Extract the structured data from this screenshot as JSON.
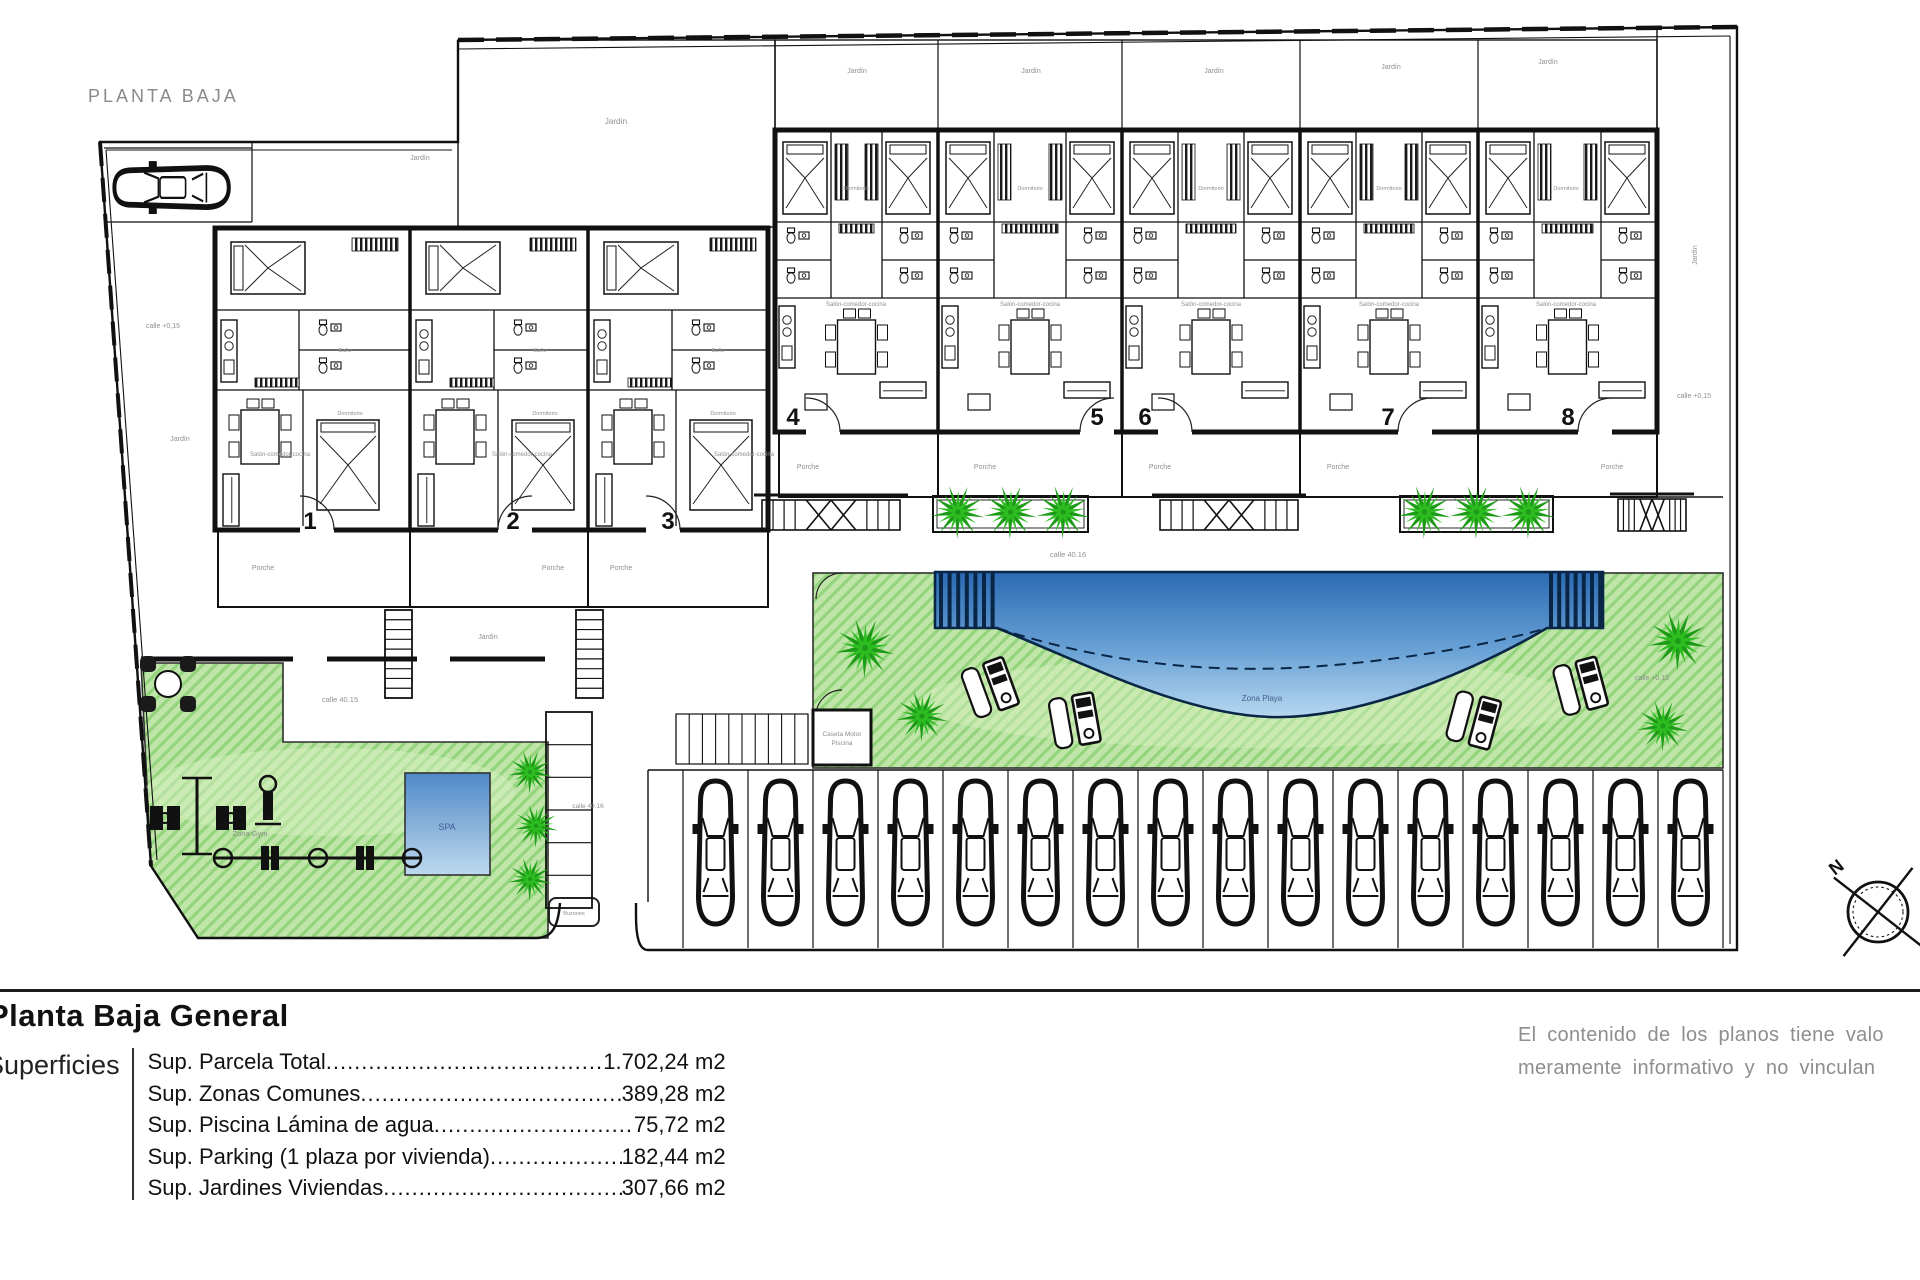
{
  "header": {
    "plan_label": "PLANTA BAJA"
  },
  "plan": {
    "units": [
      {
        "number": "1"
      },
      {
        "number": "2"
      },
      {
        "number": "3"
      },
      {
        "number": "4"
      },
      {
        "number": "5"
      },
      {
        "number": "6"
      },
      {
        "number": "7"
      },
      {
        "number": "8"
      }
    ],
    "parking": {
      "spaces": 16
    },
    "labels": {
      "porche": "Porche",
      "jardin": "Jardín",
      "salon": "Salón-comedor-cocina",
      "dormitorio": "Dormitorio",
      "bano": "Baño",
      "zona_gym": "Zona Gym",
      "spa": "SPA",
      "zona_playa": "Zona Playa",
      "caseta_1": "Caseta Motor",
      "caseta_2": "Piscina",
      "buzones": "Buzones",
      "calle_4015": "calle 40.15",
      "calle_4016": "calle 40.16",
      "cota": "calle +0,15",
      "north": "N"
    },
    "colors": {
      "lawn": "#bfe6a8",
      "lawn_stripe": "#93d47d",
      "palm": "#2dbd21",
      "palm_dark": "#1d9b17",
      "pool_top": "#2b6ab3",
      "pool_bottom": "#b7d7ef",
      "pool_line": "#0a2646",
      "wall": "#111111",
      "label_gray": "#8e8e8e"
    }
  },
  "legend": {
    "title": "Planta Baja General",
    "section": "Superficies",
    "rows": [
      {
        "label": "Sup. Parcela Total ",
        "value": "1.702,24 m2"
      },
      {
        "label": "Sup. Zonas Comunes ",
        "value": "389,28 m2"
      },
      {
        "label": "Sup. Piscina Lámina de agua",
        "value": "75,72 m2"
      },
      {
        "label": "Sup. Parking (1 plaza por vivienda)",
        "value": "182,44 m2"
      },
      {
        "label": "Sup. Jardines Viviendas",
        "value": "307,66 m2"
      }
    ],
    "disclaimer_line1": "El contenido de los planos tiene valo",
    "disclaimer_line2": "meramente informativo y no vinculan"
  }
}
